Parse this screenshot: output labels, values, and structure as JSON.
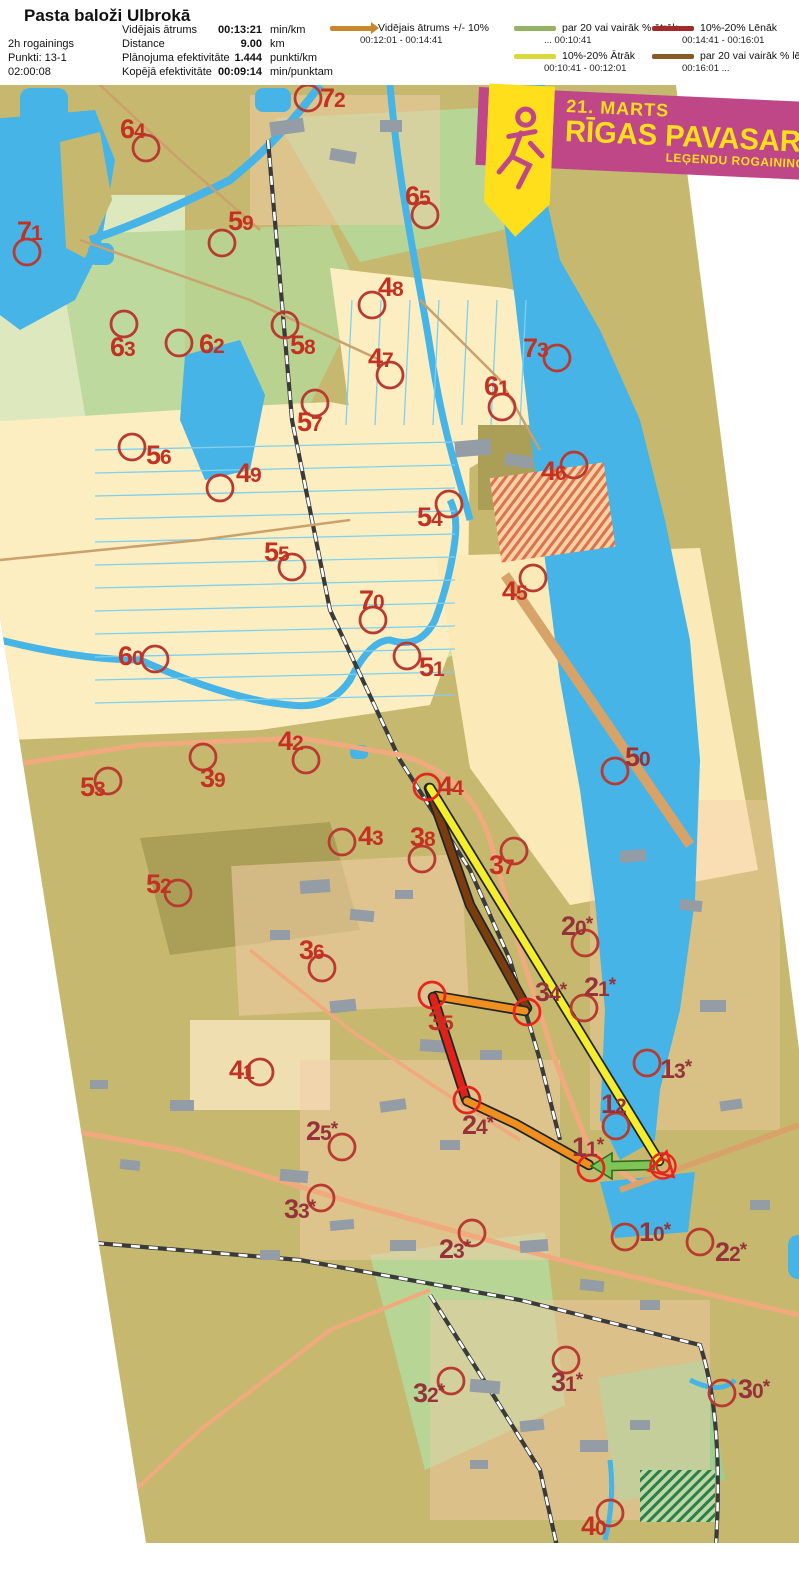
{
  "header": {
    "title": "Pasta baloži Ulbrokā",
    "info": [
      "2h rogainings",
      "Punkti: 13-1",
      "02:00:08"
    ],
    "stats": [
      {
        "label": "Vidējais ātrums",
        "value": "00:13:21",
        "unit": "min/km"
      },
      {
        "label": "Distance",
        "value": "9.00",
        "unit": "km"
      },
      {
        "label": "Plānojuma efektivitāte",
        "value": "1.444",
        "unit": "punkti/km"
      },
      {
        "label": "Kopējā efektivitāte",
        "value": "00:09:14",
        "unit": "min/punktam"
      }
    ],
    "legend": [
      {
        "label": "Vidējais ātrums +/- 10%",
        "range": "00:12:01  -  00:14:41",
        "color": "#c9872b",
        "arrow": true,
        "x": 330,
        "y": 22
      },
      {
        "label": "par 20 vai vairāk % ātrāk",
        "range": "...  00:10:41",
        "color": "#93b263",
        "arrow": false,
        "x": 514,
        "y": 22
      },
      {
        "label": "10%-20% Ātrāk",
        "range": "00:10:41  -  00:12:01",
        "color": "#d9d93c",
        "arrow": false,
        "x": 514,
        "y": 50
      },
      {
        "label": "10%-20% Lēnāk",
        "range": "00:14:41  -  00:16:01",
        "color": "#a22a28",
        "arrow": false,
        "x": 652,
        "y": 22
      },
      {
        "label": "par 20 vai vairāk % lēnāk",
        "range": "00:16:01  ...",
        "color": "#8a5a26",
        "arrow": false,
        "x": 652,
        "y": 50
      }
    ]
  },
  "banner": {
    "date": "21. MARTS",
    "title": "RĪGAS PAVASARA",
    "subtitle": "LEĢENDU ROGAININGS",
    "bg": "#bf4788",
    "accent": "#ffdf1b"
  },
  "map": {
    "colors": {
      "olive": "#c6b96f",
      "olive2": "#ab9f58",
      "field": "#fdeec2",
      "field2": "#fbeab7",
      "green": "#b7d696",
      "green2": "#cfe2a8",
      "ltgreen": "#dde8bf",
      "water": "#46b4e6",
      "ditch": "#7fd0ee",
      "road": "#f1a97e",
      "roadDark": "#d8a368",
      "gray": "#949ca6",
      "urban": "#f4cda9",
      "labelBright": "#c43122",
      "labelDark": "#96333a",
      "circle": "#b83a30",
      "circleRoute": "#e8251c",
      "paceAvg": "#ef8f1f",
      "paceFast10": "#f4ee2e",
      "paceFast20": "#7ec457",
      "paceSlow10": "#e0211a",
      "paceSlow20": "#7b3c10",
      "outline": "#242424"
    },
    "visit_order": [
      "Start",
      "11*",
      "24*",
      "35",
      "34*",
      "44",
      "Finish"
    ],
    "finish": {
      "x": 663,
      "y": 1166
    },
    "route": {
      "segments": [
        {
          "name": "leg-34-44",
          "pace": "paceSlow20",
          "points": [
            [
              429,
              788
            ],
            [
              470,
              905
            ],
            [
              527,
              1008
            ]
          ]
        },
        {
          "name": "leg-44-finish",
          "pace": "paceFast10",
          "points": [
            [
              430,
              788
            ],
            [
              659,
              1161
            ]
          ]
        },
        {
          "name": "leg-35-34",
          "pace": "paceAvg",
          "points": [
            [
              525,
              1011
            ],
            [
              436,
              996
            ]
          ]
        },
        {
          "name": "leg-24-35",
          "pace": "paceSlow10",
          "points": [
            [
              433,
              997
            ],
            [
              466,
              1099
            ]
          ]
        },
        {
          "name": "leg-11-24",
          "pace": "paceAvg",
          "points": [
            [
              467,
              1101
            ],
            [
              516,
              1124
            ],
            [
              589,
              1165
            ]
          ]
        }
      ],
      "arrow": {
        "name": "leg-start-11",
        "pace": "paceFast20",
        "tail": [
          654,
          1165
        ],
        "head": [
          591,
          1166
        ]
      }
    },
    "controls": [
      {
        "n": "72",
        "cx": 308,
        "cy": 98,
        "lx": 320,
        "ly": 107
      },
      {
        "n": "64",
        "cx": 146,
        "cy": 148,
        "lx": 120,
        "ly": 138
      },
      {
        "n": "71",
        "cx": 27,
        "cy": 252,
        "lx": 17,
        "ly": 240
      },
      {
        "n": "59",
        "cx": 222,
        "cy": 243,
        "lx": 228,
        "ly": 230
      },
      {
        "n": "65",
        "cx": 425,
        "cy": 215,
        "lx": 405,
        "ly": 205
      },
      {
        "n": "48",
        "cx": 372,
        "cy": 305,
        "lx": 378,
        "ly": 296
      },
      {
        "n": "63",
        "cx": 124,
        "cy": 324,
        "lx": 110,
        "ly": 356
      },
      {
        "n": "62",
        "cx": 179,
        "cy": 343,
        "lx": 199,
        "ly": 353
      },
      {
        "n": "58",
        "cx": 285,
        "cy": 325,
        "lx": 290,
        "ly": 354
      },
      {
        "n": "47",
        "cx": 390,
        "cy": 375,
        "lx": 368,
        "ly": 367
      },
      {
        "n": "73",
        "cx": 557,
        "cy": 358,
        "lx": 523,
        "ly": 357
      },
      {
        "n": "61",
        "cx": 502,
        "cy": 407,
        "lx": 484,
        "ly": 395
      },
      {
        "n": "57",
        "cx": 315,
        "cy": 403,
        "lx": 297,
        "ly": 431
      },
      {
        "n": "56",
        "cx": 132,
        "cy": 447,
        "lx": 146,
        "ly": 464
      },
      {
        "n": "49",
        "cx": 220,
        "cy": 488,
        "lx": 236,
        "ly": 482
      },
      {
        "n": "46",
        "cx": 574,
        "cy": 465,
        "lx": 541,
        "ly": 480
      },
      {
        "n": "54",
        "cx": 449,
        "cy": 504,
        "lx": 417,
        "ly": 526
      },
      {
        "n": "55",
        "cx": 292,
        "cy": 567,
        "lx": 264,
        "ly": 561
      },
      {
        "n": "45",
        "cx": 533,
        "cy": 578,
        "lx": 502,
        "ly": 600
      },
      {
        "n": "70",
        "cx": 373,
        "cy": 620,
        "lx": 359,
        "ly": 609
      },
      {
        "n": "51",
        "cx": 407,
        "cy": 656,
        "lx": 419,
        "ly": 676
      },
      {
        "n": "60",
        "cx": 155,
        "cy": 659,
        "lx": 118,
        "ly": 665
      },
      {
        "n": "50",
        "cx": 615,
        "cy": 771,
        "lx": 625,
        "ly": 766,
        "dark": true
      },
      {
        "n": "42",
        "cx": 306,
        "cy": 760,
        "lx": 278,
        "ly": 750
      },
      {
        "n": "39",
        "cx": 203,
        "cy": 757,
        "lx": 200,
        "ly": 787
      },
      {
        "n": "53",
        "cx": 108,
        "cy": 781,
        "lx": 80,
        "ly": 796
      },
      {
        "n": "44",
        "cx": 427,
        "cy": 787,
        "lx": 438,
        "ly": 795,
        "route": true
      },
      {
        "n": "43",
        "cx": 342,
        "cy": 842,
        "lx": 358,
        "ly": 845
      },
      {
        "n": "38",
        "cx": 422,
        "cy": 859,
        "lx": 410,
        "ly": 846
      },
      {
        "n": "37",
        "cx": 514,
        "cy": 851,
        "lx": 489,
        "ly": 874
      },
      {
        "n": "52",
        "cx": 178,
        "cy": 893,
        "lx": 146,
        "ly": 893
      },
      {
        "n": "20",
        "star": true,
        "cx": 585,
        "cy": 943,
        "lx": 561,
        "ly": 935,
        "dark": true
      },
      {
        "n": "36",
        "cx": 322,
        "cy": 968,
        "lx": 299,
        "ly": 959
      },
      {
        "n": "34",
        "star": true,
        "cx": 527,
        "cy": 1012,
        "lx": 535,
        "ly": 1001,
        "dark": true,
        "route": true
      },
      {
        "n": "21",
        "star": true,
        "cx": 584,
        "cy": 1008,
        "lx": 584,
        "ly": 996,
        "dark": true
      },
      {
        "n": "13",
        "star": true,
        "cx": 647,
        "cy": 1063,
        "lx": 660,
        "ly": 1078,
        "dark": true
      },
      {
        "n": "12",
        "cx": 616,
        "cy": 1126,
        "lx": 601,
        "ly": 1113,
        "dark": true
      },
      {
        "n": "41",
        "cx": 260,
        "cy": 1072,
        "lx": 229,
        "ly": 1079
      },
      {
        "n": "25",
        "star": true,
        "cx": 342,
        "cy": 1147,
        "lx": 306,
        "ly": 1140,
        "dark": true
      },
      {
        "n": "24",
        "star": true,
        "cx": 467,
        "cy": 1100,
        "lx": 462,
        "ly": 1134,
        "dark": true,
        "route": true
      },
      {
        "n": "11",
        "star": true,
        "cx": 591,
        "cy": 1168,
        "lx": 572,
        "ly": 1156,
        "dark": true,
        "route": true
      },
      {
        "n": "35",
        "cx": 432,
        "cy": 995,
        "lx": 428,
        "ly": 1030,
        "route": true
      },
      {
        "n": "33",
        "star": true,
        "cx": 321,
        "cy": 1198,
        "lx": 284,
        "ly": 1218,
        "dark": true
      },
      {
        "n": "23",
        "star": true,
        "cx": 472,
        "cy": 1233,
        "lx": 439,
        "ly": 1258,
        "dark": true
      },
      {
        "n": "10",
        "star": true,
        "cx": 625,
        "cy": 1237,
        "lx": 639,
        "ly": 1241,
        "dark": true
      },
      {
        "n": "22",
        "star": true,
        "cx": 700,
        "cy": 1242,
        "lx": 715,
        "ly": 1261,
        "dark": true
      },
      {
        "n": "32",
        "star": true,
        "cx": 451,
        "cy": 1381,
        "lx": 413,
        "ly": 1402,
        "dark": true
      },
      {
        "n": "31",
        "star": true,
        "cx": 566,
        "cy": 1360,
        "lx": 551,
        "ly": 1391,
        "dark": true
      },
      {
        "n": "30",
        "star": true,
        "cx": 722,
        "cy": 1393,
        "lx": 738,
        "ly": 1398,
        "dark": true
      },
      {
        "n": "40",
        "cx": 610,
        "cy": 1513,
        "lx": 581,
        "ly": 1535
      }
    ]
  }
}
